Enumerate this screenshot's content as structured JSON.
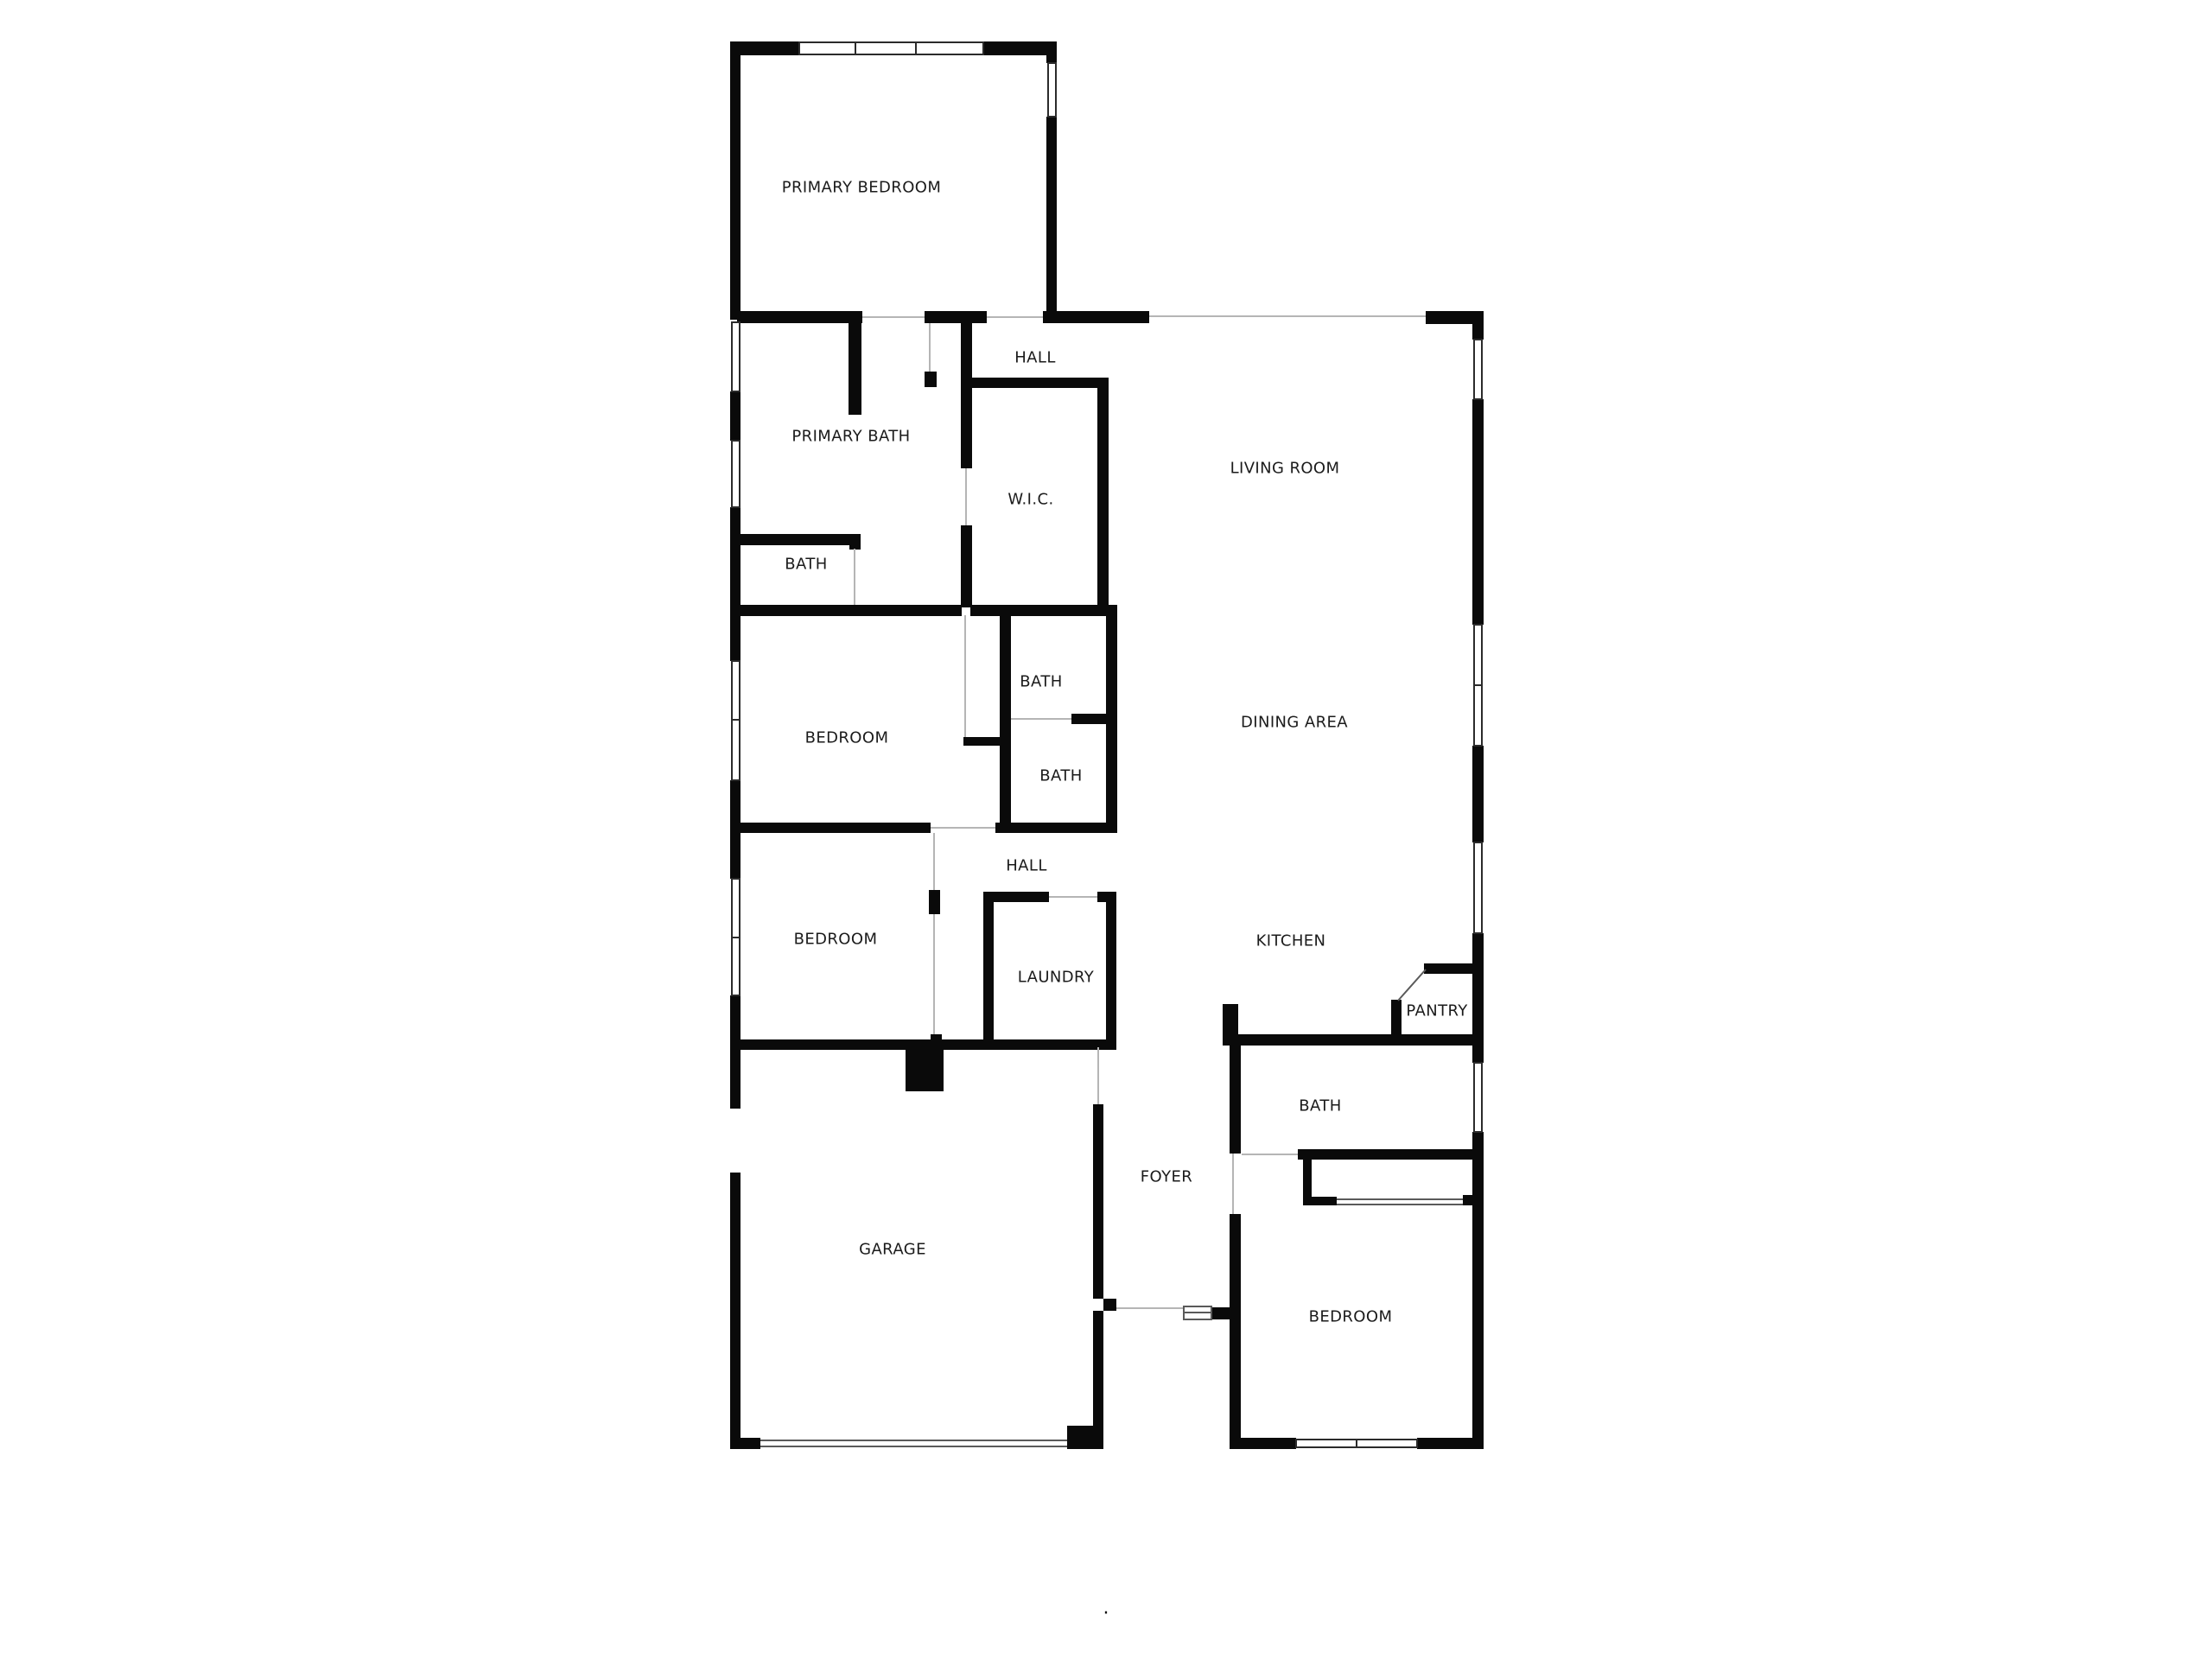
{
  "palette": {
    "background": "#ffffff",
    "wall": "#0a0a0a",
    "window_stroke": "#2b2b2b",
    "opening_line": "#b5b5b5",
    "fixture_line": "#5a5a5a",
    "label": "#1b1b1b"
  },
  "rooms": {
    "primary_bedroom": {
      "label": "PRIMARY BEDROOM"
    },
    "hall_upper": {
      "label": "HALL"
    },
    "primary_bath": {
      "label": "PRIMARY BATH"
    },
    "wic": {
      "label": "W.I.C."
    },
    "living_room": {
      "label": "LIVING ROOM"
    },
    "bath_primary": {
      "label": "BATH"
    },
    "bedroom_mid": {
      "label": "BEDROOM"
    },
    "bath_mid_upper": {
      "label": "BATH"
    },
    "bath_mid_lower": {
      "label": "BATH"
    },
    "dining_area": {
      "label": "DINING AREA"
    },
    "hall_lower": {
      "label": "HALL"
    },
    "bedroom_lower": {
      "label": "BEDROOM"
    },
    "laundry": {
      "label": "LAUNDRY"
    },
    "kitchen": {
      "label": "KITCHEN"
    },
    "pantry": {
      "label": "PANTRY"
    },
    "bath_right": {
      "label": "BATH"
    },
    "foyer": {
      "label": "FOYER"
    },
    "garage": {
      "label": "GARAGE"
    },
    "bedroom_right": {
      "label": "BEDROOM"
    }
  },
  "misc": {
    "dot": "."
  }
}
